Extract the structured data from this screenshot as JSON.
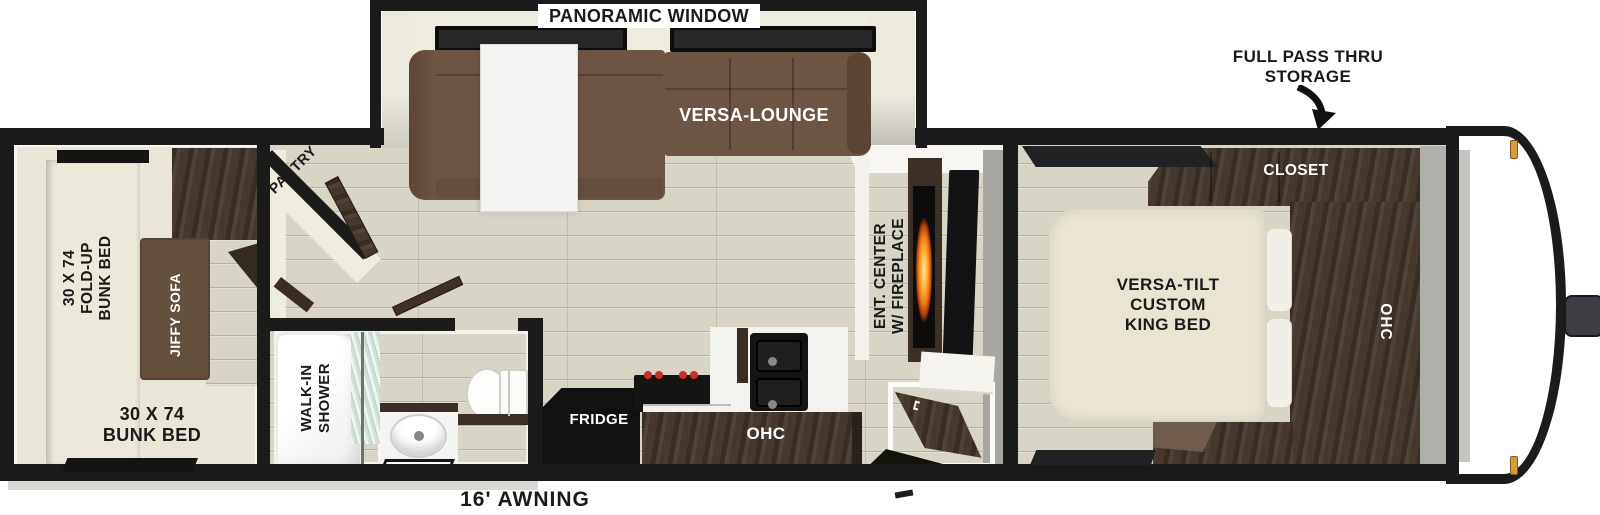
{
  "labels": {
    "panoramic_window": "PANORAMIC WINDOW",
    "full_pass_thru": [
      "FULL PASS THRU",
      "STORAGE"
    ],
    "versa_lounge": "VERSA-LOUNGE",
    "closet": "CLOSET",
    "king_bed": [
      "VERSA-TILT",
      "CUSTOM",
      "KING BED"
    ],
    "bedroom_ohc": "OHC",
    "ent_center": [
      "ENT. CENTER",
      "W/ FIREPLACE"
    ],
    "pantry": "PANTRY",
    "fold_up_bunk": [
      "30 X 74",
      "FOLD-UP",
      "BUNK BED"
    ],
    "jiffy_sofa": "JIFFY SOFA",
    "bunk_bed": [
      "30 X 74",
      "BUNK BED"
    ],
    "walk_in_shower": [
      "WALK-IN",
      "SHOWER"
    ],
    "fridge": "FRIDGE",
    "kitchen_ohc": "OHC",
    "awning": "16' AWNING"
  },
  "colors": {
    "wall": "#1b1b1b",
    "floor": "#d8d4c6",
    "carpet": "#e9e5d7",
    "sofa_brown": "#6d5546",
    "cabinet_darkwood": "#46382d",
    "bed_cream": "#e9e5d2",
    "flame_orange": "#ff9e2e",
    "clearance_amber": "#d99a3c"
  }
}
